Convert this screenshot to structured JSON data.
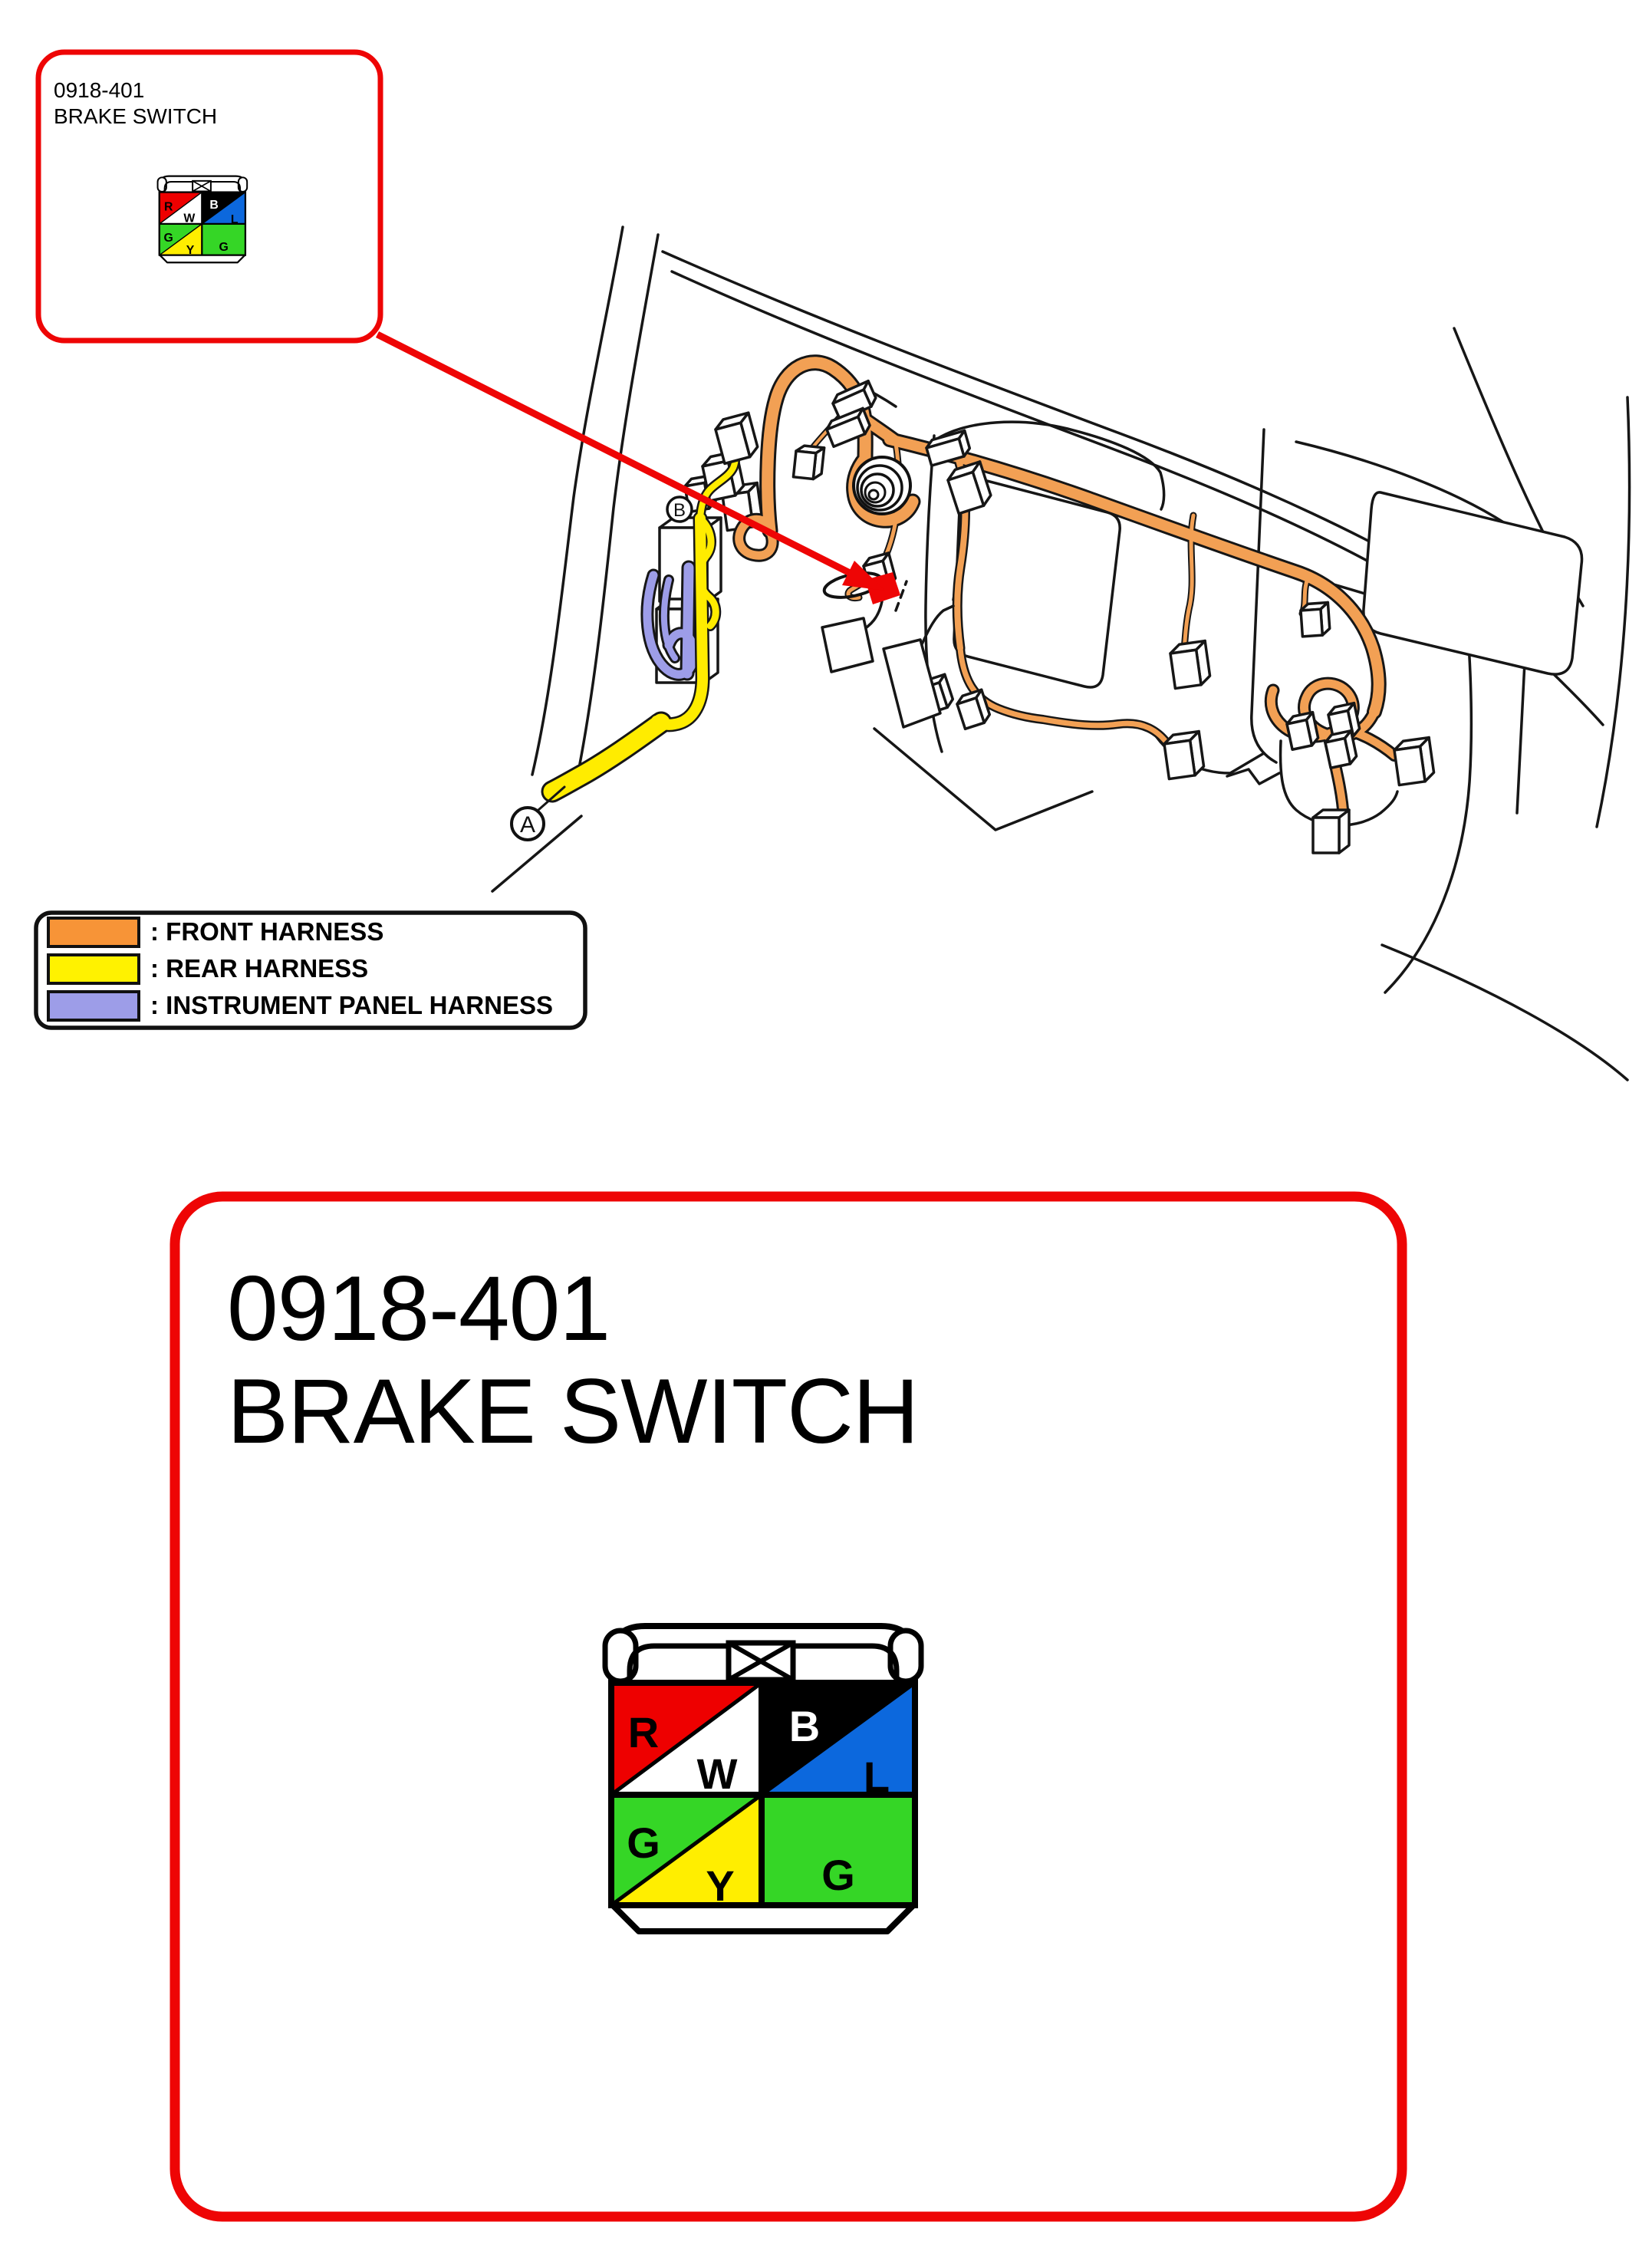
{
  "callout": {
    "code": "0918-401",
    "name": "BRAKE SWITCH"
  },
  "detail_panel": {
    "code": "0918-401",
    "name": "BRAKE SWITCH"
  },
  "legend": {
    "items": [
      {
        "label": ": FRONT HARNESS",
        "color": "#f79437"
      },
      {
        "label": ": REAR HARNESS",
        "color": "#fff200"
      },
      {
        "label": ": INSTRUMENT PANEL HARNESS",
        "color": "#9d9de8"
      }
    ]
  },
  "diagram": {
    "ref_points": {
      "a": "A",
      "b": "B"
    }
  },
  "connector_pinout": {
    "top_symbol": "bowtie",
    "cells": [
      {
        "pos": "top-left-upper",
        "label": "R",
        "color": "#ee0000"
      },
      {
        "pos": "top-left-lower",
        "label": "W",
        "color": "#ffffff"
      },
      {
        "pos": "top-right-upper",
        "label": "B",
        "color": "#000000"
      },
      {
        "pos": "top-right-lower",
        "label": "L",
        "color": "#0c68dd"
      },
      {
        "pos": "bottom-left-upper",
        "label": "G",
        "color": "#35d626"
      },
      {
        "pos": "bottom-left-lower",
        "label": "Y",
        "color": "#ffee00"
      },
      {
        "pos": "bottom-right",
        "label": "G",
        "color": "#35d626"
      }
    ]
  },
  "colors": {
    "accent_red": "#ee0505",
    "front_harness": "#f2a054",
    "rear_harness": "#ffec00",
    "instrument_harness": "#9d9de8"
  }
}
